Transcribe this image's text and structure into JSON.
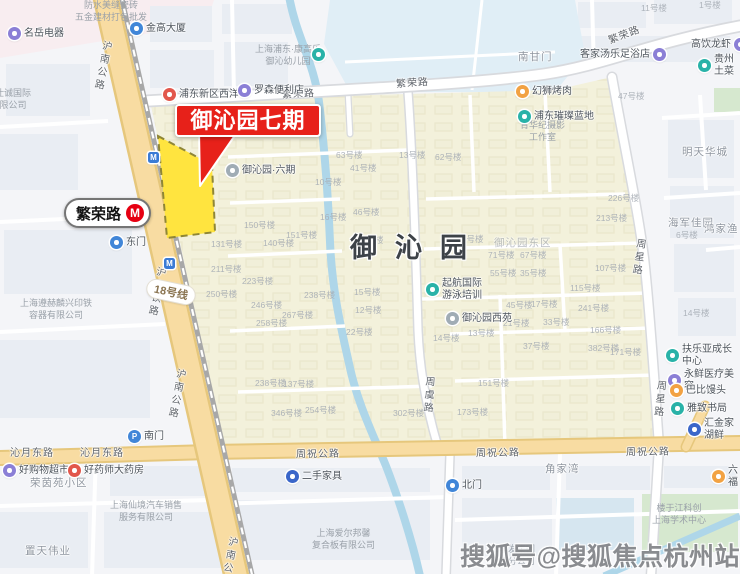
{
  "map": {
    "callout_label": "御沁园七期",
    "estate_name": "御沁园",
    "station": {
      "name": "繁荣路",
      "logo": "M"
    },
    "line_badge": "18号线",
    "watermark": "搜狐号@搜狐焦点杭州站",
    "colors": {
      "highlight_yellow": "#ffe43f",
      "callout_red": "#e7211a",
      "metro_logo_red": "#e60012",
      "road_yellow": "#f8dca2",
      "estate_beige": "#f3f1db",
      "water_blue": "#aed6e9"
    },
    "road_labels": [
      {
        "t": "沪南公路",
        "x": 96,
        "y": 40,
        "v": 1,
        "r": 11
      },
      {
        "t": "沪南公路",
        "x": 170,
        "y": 368,
        "v": 1,
        "r": 11
      },
      {
        "t": "沪南铁路",
        "x": 150,
        "y": 266,
        "v": 1,
        "r": 11
      },
      {
        "t": "沪南公路",
        "x": 222,
        "y": 536,
        "v": 1,
        "r": 11
      },
      {
        "t": "繁荣路",
        "x": 282,
        "y": 89,
        "r": -3
      },
      {
        "t": "繁荣路",
        "x": 396,
        "y": 78,
        "r": -4
      },
      {
        "t": "繁荣路",
        "x": 608,
        "y": 30,
        "r": -21
      },
      {
        "t": "周祝公路",
        "x": 296,
        "y": 449,
        "r": -1
      },
      {
        "t": "周祝公路",
        "x": 476,
        "y": 448,
        "r": -1
      },
      {
        "t": "周祝公路",
        "x": 626,
        "y": 447,
        "r": -1
      },
      {
        "t": "沁月东路",
        "x": 10,
        "y": 448
      },
      {
        "t": "沁月东路",
        "x": 80,
        "y": 448
      },
      {
        "t": "周星路",
        "x": 632,
        "y": 238,
        "v": 1,
        "r": 8
      },
      {
        "t": "周星路",
        "x": 653,
        "y": 380,
        "v": 1,
        "r": 6
      },
      {
        "t": "周虞路",
        "x": 422,
        "y": 376,
        "v": 1,
        "r": 4
      }
    ],
    "area_labels": [
      {
        "t": "明天华城",
        "x": 682,
        "y": 147
      },
      {
        "t": "御沁园东区",
        "x": 494,
        "y": 238,
        "cls": "faint"
      },
      {
        "t": "角家湾",
        "x": 545,
        "y": 464
      },
      {
        "t": "海军佳园",
        "x": 668,
        "y": 218
      },
      {
        "t": "荣茵苑小区",
        "x": 30,
        "y": 478
      },
      {
        "t": "置天伟业",
        "x": 25,
        "y": 546
      },
      {
        "t": "南甘门",
        "x": 518,
        "y": 52
      },
      {
        "t": "鸿家渔",
        "x": 704,
        "y": 224
      }
    ],
    "company_labels": [
      {
        "lines": [
          "防水美缝瓷砖",
          "五金建材打包批发"
        ],
        "x": 75,
        "y": 0
      },
      {
        "lines": [
          "万仕诚国际",
          "有限公司"
        ],
        "x": -14,
        "y": 88
      },
      {
        "lines": [
          "上海遵赫麟兴印铁",
          "容器有限公司"
        ],
        "x": 20,
        "y": 298
      },
      {
        "lines": [
          "上海浦东·康高乐",
          "御沁幼儿园"
        ],
        "x": 255,
        "y": 44
      },
      {
        "lines": [
          "青华纪摄影",
          "工作室"
        ],
        "x": 520,
        "y": 120
      },
      {
        "lines": [
          "上海仙境汽车销售",
          "服务有限公司"
        ],
        "x": 110,
        "y": 500
      },
      {
        "lines": [
          "上海爱尔邦馨",
          "复合板有限公司"
        ],
        "x": 312,
        "y": 528
      },
      {
        "lines": [
          "江丰发集团",
          "上海分公司"
        ],
        "x": 490,
        "y": 544
      },
      {
        "lines": [
          "楼于江科创",
          "上海学术中心"
        ],
        "x": 652,
        "y": 503
      }
    ],
    "pois": [
      {
        "t": "名岳电器",
        "c": "purple",
        "x": 8,
        "y": 27
      },
      {
        "t": "金高大厦",
        "c": "blue",
        "x": 130,
        "y": 22
      },
      {
        "t": "浦东新区西洋",
        "c": "red",
        "x": 163,
        "y": 88
      },
      {
        "t": "罗森便利店",
        "c": "purple",
        "x": 238,
        "y": 84
      },
      {
        "t": "",
        "c": "teal",
        "x": 312,
        "y": 48
      },
      {
        "t": "御沁园·六期",
        "c": "gray",
        "x": 226,
        "y": 164
      },
      {
        "t": "客家汤乐足浴店",
        "c": "purple",
        "x": 652,
        "y": 48,
        "side": "left"
      },
      {
        "t": "高饮龙虾",
        "c": "purple",
        "x": 733,
        "y": 38,
        "side": "left"
      },
      {
        "t": "贵州土菜",
        "c": "teal",
        "x": 698,
        "y": 54
      },
      {
        "t": "幻狮烤肉",
        "c": "orange",
        "x": 516,
        "y": 85
      },
      {
        "t": "浦东璀璨蓝地",
        "c": "teal",
        "x": 518,
        "y": 110
      },
      {
        "t": "起航国际",
        "t2": "游泳培训",
        "c": "teal",
        "x": 426,
        "y": 278
      },
      {
        "t": "御沁园西苑",
        "c": "gray",
        "x": 446,
        "y": 312
      },
      {
        "t": "二手家具",
        "c": "bluedark",
        "x": 286,
        "y": 470
      },
      {
        "t": "南门",
        "c": "blue",
        "x": 128,
        "y": 430,
        "g": "P"
      },
      {
        "t": "东门",
        "c": "blue",
        "x": 110,
        "y": 236
      },
      {
        "t": "北门",
        "c": "blue",
        "x": 446,
        "y": 479
      },
      {
        "t": "扶乐亚成长中心",
        "c": "teal",
        "x": 666,
        "y": 344
      },
      {
        "t": "永鲜医疗美容",
        "c": "purple",
        "x": 668,
        "y": 369
      },
      {
        "t": "巴比馒头",
        "c": "orange",
        "x": 670,
        "y": 384
      },
      {
        "t": "雅致书局",
        "c": "teal",
        "x": 671,
        "y": 402
      },
      {
        "t": "汇金家湖鲜",
        "c": "bluedark",
        "x": 688,
        "y": 418
      },
      {
        "t": "六福",
        "c": "orange",
        "x": 712,
        "y": 465
      },
      {
        "t": "好购物超市",
        "c": "purple",
        "x": 3,
        "y": 464
      },
      {
        "t": "好药师大药房",
        "c": "red",
        "x": 68,
        "y": 464
      },
      {
        "t": "",
        "c": "metro",
        "x": 148,
        "y": 152
      },
      {
        "t": "",
        "c": "metro",
        "x": 164,
        "y": 258
      }
    ],
    "building_labels": [
      {
        "t": "150号楼",
        "x": 244,
        "y": 221
      },
      {
        "t": "140号楼",
        "x": 263,
        "y": 239
      },
      {
        "t": "151号楼",
        "x": 286,
        "y": 231
      },
      {
        "t": "131号楼",
        "x": 211,
        "y": 240
      },
      {
        "t": "211号楼",
        "x": 211,
        "y": 265
      },
      {
        "t": "223号楼",
        "x": 242,
        "y": 277
      },
      {
        "t": "250号楼",
        "x": 206,
        "y": 290
      },
      {
        "t": "246号楼",
        "x": 251,
        "y": 301
      },
      {
        "t": "258号楼",
        "x": 256,
        "y": 319
      },
      {
        "t": "267号楼",
        "x": 282,
        "y": 311
      },
      {
        "t": "238号楼",
        "x": 304,
        "y": 291
      },
      {
        "t": "10号楼",
        "x": 315,
        "y": 178
      },
      {
        "t": "16号楼",
        "x": 320,
        "y": 213
      },
      {
        "t": "46号楼",
        "x": 353,
        "y": 208
      },
      {
        "t": "23号楼",
        "x": 357,
        "y": 236
      },
      {
        "t": "63号楼",
        "x": 336,
        "y": 151
      },
      {
        "t": "41号楼",
        "x": 350,
        "y": 164
      },
      {
        "t": "15号楼",
        "x": 354,
        "y": 288
      },
      {
        "t": "12号楼",
        "x": 355,
        "y": 306
      },
      {
        "t": "22号楼",
        "x": 346,
        "y": 328
      },
      {
        "t": "13号楼",
        "x": 399,
        "y": 151
      },
      {
        "t": "62号楼",
        "x": 435,
        "y": 153
      },
      {
        "t": "15号楼",
        "x": 457,
        "y": 235
      },
      {
        "t": "71号楼",
        "x": 488,
        "y": 251
      },
      {
        "t": "67号楼",
        "x": 520,
        "y": 251
      },
      {
        "t": "55号楼",
        "x": 490,
        "y": 269
      },
      {
        "t": "35号楼",
        "x": 520,
        "y": 269
      },
      {
        "t": "115号楼",
        "x": 570,
        "y": 284
      },
      {
        "t": "107号楼",
        "x": 595,
        "y": 264
      },
      {
        "t": "241号楼",
        "x": 578,
        "y": 304
      },
      {
        "t": "45号楼",
        "x": 506,
        "y": 301
      },
      {
        "t": "17号楼",
        "x": 531,
        "y": 300
      },
      {
        "t": "21号楼",
        "x": 503,
        "y": 319
      },
      {
        "t": "33号楼",
        "x": 543,
        "y": 318
      },
      {
        "t": "13号楼",
        "x": 468,
        "y": 329
      },
      {
        "t": "14号楼",
        "x": 433,
        "y": 334
      },
      {
        "t": "166号楼",
        "x": 590,
        "y": 326
      },
      {
        "t": "382号楼",
        "x": 588,
        "y": 344
      },
      {
        "t": "171号楼",
        "x": 610,
        "y": 348
      },
      {
        "t": "37号楼",
        "x": 523,
        "y": 342
      },
      {
        "t": "47号楼",
        "x": 618,
        "y": 92
      },
      {
        "t": "11号楼",
        "x": 641,
        "y": 4
      },
      {
        "t": "1号楼",
        "x": 699,
        "y": 1
      },
      {
        "t": "226号楼",
        "x": 608,
        "y": 194
      },
      {
        "t": "213号楼",
        "x": 596,
        "y": 214
      },
      {
        "t": "14号楼",
        "x": 683,
        "y": 309
      },
      {
        "t": "6号楼",
        "x": 676,
        "y": 231
      },
      {
        "t": "238号楼",
        "x": 255,
        "y": 379
      },
      {
        "t": "137号楼",
        "x": 283,
        "y": 380
      },
      {
        "t": "346号楼",
        "x": 271,
        "y": 409
      },
      {
        "t": "254号楼",
        "x": 305,
        "y": 406
      },
      {
        "t": "302号楼",
        "x": 393,
        "y": 409
      },
      {
        "t": "173号楼",
        "x": 457,
        "y": 408
      },
      {
        "t": "151号楼",
        "x": 478,
        "y": 379
      }
    ]
  }
}
